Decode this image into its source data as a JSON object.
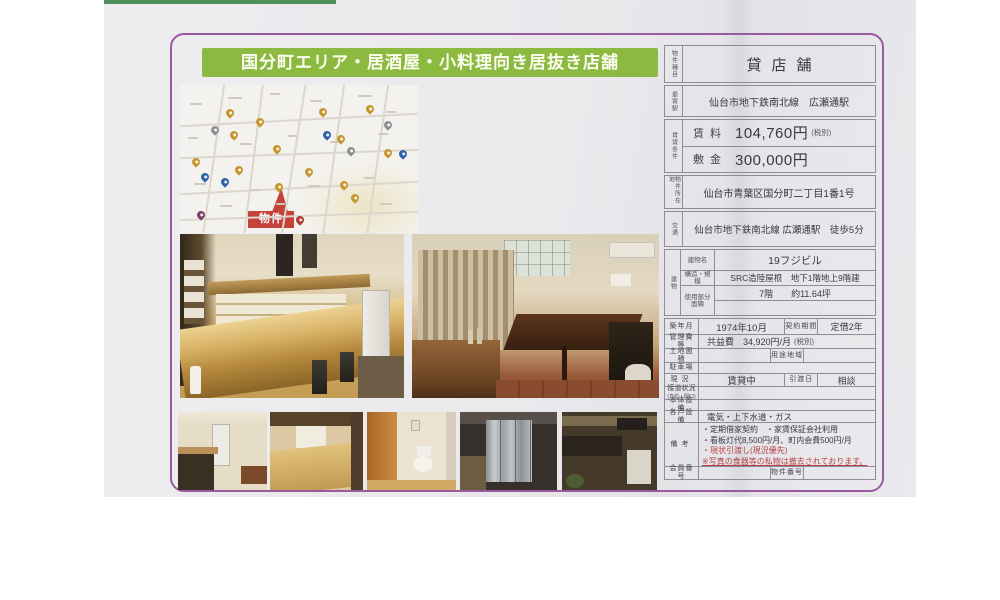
{
  "colors": {
    "title_bar_green": "#8cb93f",
    "flyer_border_purple": "#9a5aa0",
    "badge_red": "#c6403c",
    "remark_red": "#b84343"
  },
  "flyer": {
    "title": "国分町エリア・居酒屋・小料理向き居抜き店舗",
    "map": {
      "property_badge": "物件"
    },
    "table": {
      "property_type_label": "物件種目",
      "property_type": "貸店舗",
      "station_label": "最寄駅",
      "station": "仙台市地下鉄南北線　広瀬通駅",
      "terms_label": "賃貸条件",
      "rent_label": "賃料",
      "rent_value": "104,760円",
      "rent_note": "(税別)",
      "deposit_label": "敷金",
      "deposit_value": "300,000円",
      "address_label": "物件所在地",
      "address": "仙台市青葉区国分町二丁目1番1号",
      "access_label": "交通",
      "access": "仙台市地下鉄南北線 広瀬通駅　徒歩5分",
      "building_label": "建物",
      "building_name_label": "建物名",
      "building_name": "19フジビル",
      "structure_label": "構造・規模",
      "structure": "SRC造陸屋根　地下1階地上9階建",
      "floor_area_label": "使用部分面積",
      "floor_area": "7階　　約11.64坪",
      "built_label": "築年月",
      "built": "1974年10月",
      "contract_label": "契約期間",
      "contract": "定借2年",
      "management_label": "管理費等",
      "management": "共益費　34,920円/月",
      "management_note": "(税別)",
      "land_label": "土地面積",
      "zoning_label": "用途地域",
      "parking_label": "駐車場",
      "status_label": "現況",
      "status": "賃貸中",
      "handover_label": "引渡日",
      "handover": "相談",
      "road_label": "接道状況",
      "road_sublabel": "(方位・間口)",
      "body_equipment_label": "本体設備",
      "unit_equipment_label": "各戸設備",
      "unit_equipment": "電気・上下水道・ガス",
      "remarks_label": "備考",
      "remarks": {
        "line1": "・定期借家契約　・家賃保証会社利用",
        "line2": "・看板灯代8,500円/月、町内会費500円/月",
        "line3": "・現状引渡し(現況優先)",
        "line4": "※写真の食器等の私物は撤去されております。"
      },
      "member_no_label": "会員番号",
      "property_no_label": "物件番号"
    }
  }
}
